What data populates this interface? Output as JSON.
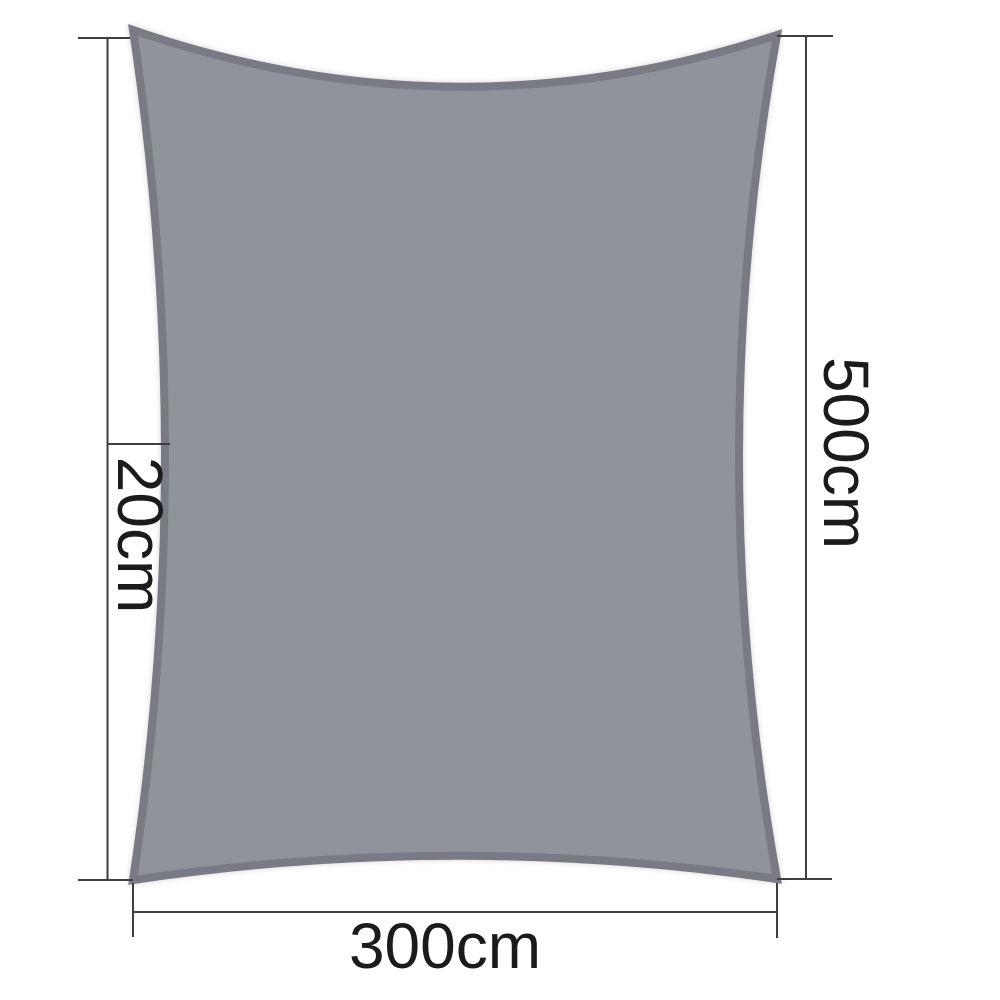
{
  "labels": {
    "left_dimension": "20cm",
    "right_dimension": "500cm",
    "bottom_dimension": "300cm"
  },
  "colors": {
    "background": "#FFFFFF",
    "sail_fill": "#90939C",
    "sail_edge": "#797A83",
    "dimension_line": "#3E3E42",
    "label_text": "#1B1B1D"
  }
}
